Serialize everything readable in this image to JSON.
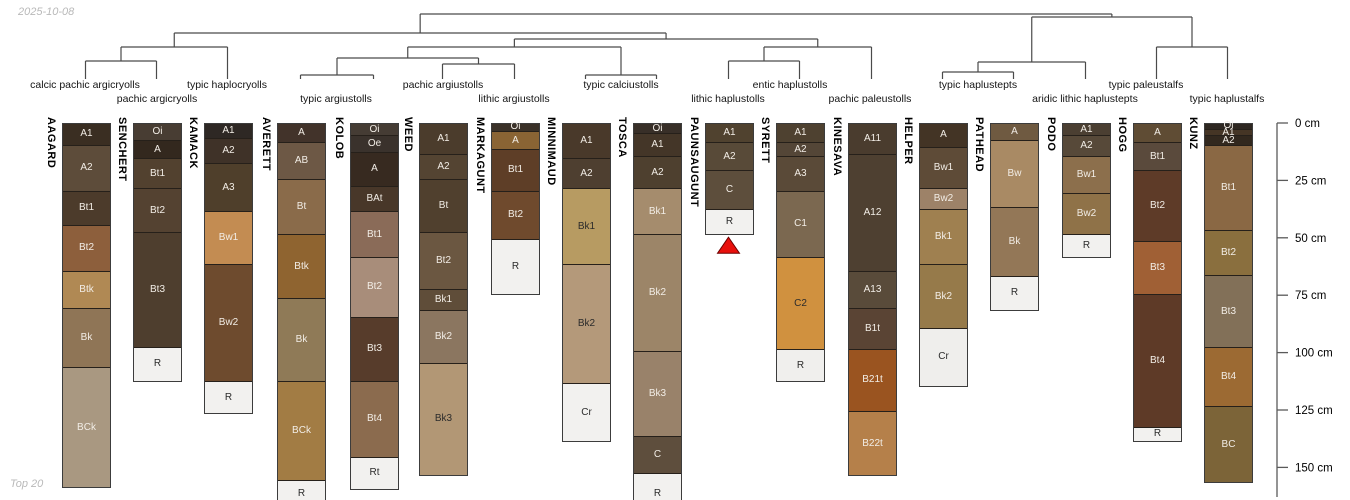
{
  "meta": {
    "date_label": "2025-10-08",
    "footer_label": "Top 20"
  },
  "colors": {
    "dendrogram_line": "#4a4a4a",
    "axis_line": "#5a5a5a",
    "column_border": "#3c3c3c",
    "horizon_divider": "#26201a",
    "label_light": "#f2ede6",
    "label_dark": "#2b2b2b",
    "marker_fill": "#e8100c",
    "marker_border": "#6d0000"
  },
  "chart_data": {
    "type": "soil-profile-dendrogram",
    "description": "Dendrogram of 17 soil series grouped by subgroup taxonomy above soil profile sketches with horizon designations and a depth axis in cm",
    "depth_axis": {
      "unit": "cm",
      "ticks": [
        0,
        25,
        50,
        75,
        100,
        125,
        150
      ],
      "tick_suffix": " cm"
    },
    "taxa_labels": [
      {
        "text": "calcic pachic argicryolls",
        "x": 85,
        "row": 1
      },
      {
        "text": "pachic argicryolls",
        "x": 157,
        "row": 2
      },
      {
        "text": "typic haplocryolls",
        "x": 227,
        "row": 1
      },
      {
        "text": "typic argiustolls",
        "x": 336,
        "row": 2
      },
      {
        "text": "pachic argiustolls",
        "x": 443,
        "row": 1
      },
      {
        "text": "lithic argiustolls",
        "x": 514,
        "row": 2
      },
      {
        "text": "typic calciustolls",
        "x": 621,
        "row": 1
      },
      {
        "text": "lithic haplustolls",
        "x": 728,
        "row": 2
      },
      {
        "text": "entic haplustolls",
        "x": 790,
        "row": 1
      },
      {
        "text": "pachic paleustolls",
        "x": 870,
        "row": 2
      },
      {
        "text": "typic haplustepts",
        "x": 978,
        "row": 1
      },
      {
        "text": "aridic lithic haplustepts",
        "x": 1085,
        "row": 2
      },
      {
        "text": "typic paleustalfs",
        "x": 1146,
        "row": 1
      },
      {
        "text": "typic haplustalfs",
        "x": 1227,
        "row": 2
      }
    ],
    "profiles": [
      {
        "id": "AAGARD",
        "x": 62,
        "horizons": [
          [
            "A1",
            0,
            9,
            "#3a2e22"
          ],
          [
            "A2",
            9,
            29,
            "#5d4c3a"
          ],
          [
            "Bt1",
            29,
            44,
            "#4c3b2b"
          ],
          [
            "Bt2",
            44,
            64,
            "#8d5f3c"
          ],
          [
            "Btk",
            64,
            80,
            "#b08954"
          ],
          [
            "Bk",
            80,
            106,
            "#8f7556"
          ],
          [
            "BCk",
            106,
            158,
            "#a99881"
          ]
        ]
      },
      {
        "id": "SENCHERT",
        "x": 133,
        "horizons": [
          [
            "Oi",
            0,
            7,
            "#483d33"
          ],
          [
            "A",
            7,
            15,
            "#33281e"
          ],
          [
            "Bt1",
            15,
            28,
            "#52412f"
          ],
          [
            "Bt2",
            28,
            47,
            "#544231"
          ],
          [
            "Bt3",
            47,
            97,
            "#4e3e2e"
          ],
          [
            "R",
            97,
            112,
            "#f2f1ef"
          ]
        ]
      },
      {
        "id": "KAMACK",
        "x": 204,
        "horizons": [
          [
            "A1",
            0,
            6,
            "#2e2824"
          ],
          [
            "A2",
            6,
            17,
            "#3f3228"
          ],
          [
            "A3",
            17,
            38,
            "#4f3f2b"
          ],
          [
            "Bw1",
            38,
            61,
            "#c38c52"
          ],
          [
            "Bw2",
            61,
            112,
            "#6e4b2e"
          ],
          [
            "R",
            112,
            126,
            "#f2f1ef"
          ]
        ]
      },
      {
        "id": "AVERETT",
        "x": 277,
        "horizons": [
          [
            "A",
            0,
            8,
            "#42332a"
          ],
          [
            "AB",
            8,
            24,
            "#6d5845"
          ],
          [
            "Bt",
            24,
            48,
            "#8a6b4a"
          ],
          [
            "Btk",
            48,
            76,
            "#8f6430"
          ],
          [
            "Bk",
            76,
            112,
            "#8f7a57"
          ],
          [
            "BCk",
            112,
            155,
            "#a27c44"
          ],
          [
            "R",
            155,
            167,
            "#f2f1ef"
          ]
        ]
      },
      {
        "id": "KOLOB",
        "x": 350,
        "horizons": [
          [
            "Oi",
            0,
            5,
            "#453c34"
          ],
          [
            "Oe",
            5,
            12,
            "#3a322c"
          ],
          [
            "A",
            12,
            27,
            "#372a20"
          ],
          [
            "BAt",
            27,
            38,
            "#483729"
          ],
          [
            "Bt1",
            38,
            58,
            "#8a6b58"
          ],
          [
            "Bt2",
            58,
            84,
            "#a88d7a"
          ],
          [
            "Bt3",
            84,
            112,
            "#573c2b"
          ],
          [
            "Bt4",
            112,
            145,
            "#8b6b4e"
          ],
          [
            "Rt",
            145,
            159,
            "#f2f1ef"
          ]
        ]
      },
      {
        "id": "WEED",
        "x": 419,
        "horizons": [
          [
            "A1",
            0,
            13,
            "#4b3c2c"
          ],
          [
            "A2",
            13,
            24,
            "#544432"
          ],
          [
            "Bt",
            24,
            47,
            "#50402e"
          ],
          [
            "Bt2",
            47,
            72,
            "#6b5741"
          ],
          [
            "Bk1",
            72,
            81,
            "#5f4d39"
          ],
          [
            "Bk2",
            81,
            104,
            "#8b7660"
          ],
          [
            "Bk3",
            104,
            153,
            "#b29775",
            "dark"
          ]
        ]
      },
      {
        "id": "MARKAGUNT",
        "x": 491,
        "horizons": [
          [
            "Oi",
            0,
            3,
            "#3a3128"
          ],
          [
            "A",
            3,
            11,
            "#8a6434"
          ],
          [
            "Bt1",
            11,
            29,
            "#5e3e27"
          ],
          [
            "Bt2",
            29,
            50,
            "#6f4a2d"
          ],
          [
            "R",
            50,
            74,
            "#f2f1ef"
          ]
        ]
      },
      {
        "id": "MINNIMAUD",
        "x": 562,
        "horizons": [
          [
            "A1",
            0,
            15,
            "#49392a"
          ],
          [
            "A2",
            15,
            28,
            "#4e3f30"
          ],
          [
            "Bk1",
            28,
            61,
            "#b79b62",
            "dark"
          ],
          [
            "Bk2",
            61,
            113,
            "#b4997a",
            "dark"
          ],
          [
            "Cr",
            113,
            138,
            "#f2f1ef"
          ]
        ]
      },
      {
        "id": "TOSCA",
        "x": 633,
        "horizons": [
          [
            "Oi",
            0,
            4,
            "#382f28"
          ],
          [
            "A1",
            4,
            14,
            "#443628"
          ],
          [
            "A2",
            14,
            28,
            "#4e402f"
          ],
          [
            "Bk1",
            28,
            48,
            "#a58c6d"
          ],
          [
            "Bk2",
            48,
            99,
            "#9c8568"
          ],
          [
            "Bk3",
            99,
            136,
            "#99826a"
          ],
          [
            "C",
            136,
            152,
            "#5e4e3d"
          ],
          [
            "R",
            152,
            170,
            "#f2f1ef"
          ]
        ]
      },
      {
        "id": "PAUNSAUGUNT",
        "x": 705,
        "horizons": [
          [
            "A1",
            0,
            8,
            "#50422f"
          ],
          [
            "A2",
            8,
            20,
            "#584a38"
          ],
          [
            "C",
            20,
            37,
            "#5d4e3c"
          ],
          [
            "R",
            37,
            48,
            "#f2f1ef"
          ]
        ]
      },
      {
        "id": "SYRETT",
        "x": 776,
        "horizons": [
          [
            "A1",
            0,
            8,
            "#4e4130"
          ],
          [
            "A2",
            8,
            14,
            "#544637"
          ],
          [
            "A3",
            14,
            29,
            "#5a4a38"
          ],
          [
            "C1",
            29,
            58,
            "#7b6850"
          ],
          [
            "C2",
            58,
            98,
            "#d0913f",
            "dark"
          ],
          [
            "R",
            98,
            112,
            "#f0efed"
          ]
        ]
      },
      {
        "id": "KINESAVA",
        "x": 848,
        "horizons": [
          [
            "A11",
            0,
            13,
            "#4a3c2e"
          ],
          [
            "A12",
            13,
            64,
            "#4e4031"
          ],
          [
            "A13",
            64,
            80,
            "#594b3a"
          ],
          [
            "B1t",
            80,
            98,
            "#5a4434"
          ],
          [
            "B21t",
            98,
            125,
            "#9a5420"
          ],
          [
            "B22t",
            125,
            153,
            "#b5804a"
          ]
        ]
      },
      {
        "id": "HELPER",
        "x": 919,
        "horizons": [
          [
            "A",
            0,
            10,
            "#433425"
          ],
          [
            "Bw1",
            10,
            28,
            "#5e4b37"
          ],
          [
            "Bw2",
            28,
            37,
            "#9d8268"
          ],
          [
            "Bk1",
            37,
            61,
            "#9f8050"
          ],
          [
            "Bk2",
            61,
            89,
            "#967a4a"
          ],
          [
            "Cr",
            89,
            114,
            "#efeeec"
          ]
        ]
      },
      {
        "id": "PATHEAD",
        "x": 990,
        "horizons": [
          [
            "A",
            0,
            7,
            "#6f5a41"
          ],
          [
            "Bw",
            7,
            36,
            "#a98a64"
          ],
          [
            "Bk",
            36,
            66,
            "#937757"
          ],
          [
            "R",
            66,
            81,
            "#f2f1ef"
          ]
        ]
      },
      {
        "id": "PODO",
        "x": 1062,
        "horizons": [
          [
            "A1",
            0,
            5,
            "#4b3f32"
          ],
          [
            "A2",
            5,
            14,
            "#574939"
          ],
          [
            "Bw1",
            14,
            30,
            "#8c6f4c"
          ],
          [
            "Bw2",
            30,
            48,
            "#8f7248"
          ],
          [
            "R",
            48,
            58,
            "#f2f1ef"
          ]
        ]
      },
      {
        "id": "HOGG",
        "x": 1133,
        "horizons": [
          [
            "A",
            0,
            8,
            "#5f4c34"
          ],
          [
            "Bt1",
            8,
            20,
            "#5a4a3c"
          ],
          [
            "Bt2",
            20,
            51,
            "#5e3b28"
          ],
          [
            "Bt3",
            51,
            74,
            "#a06035"
          ],
          [
            "Bt4",
            74,
            132,
            "#5e3a27"
          ],
          [
            "R",
            132,
            138,
            "#f2f1ef"
          ]
        ]
      },
      {
        "id": "KUNZ",
        "x": 1204,
        "horizons": [
          [
            "Oi",
            0,
            2,
            "#2e2721"
          ],
          [
            "A1",
            2,
            5,
            "#453525"
          ],
          [
            "A2",
            5,
            9,
            "#32281e"
          ],
          [
            "Bt1",
            9,
            46,
            "#8a6844"
          ],
          [
            "Bt2",
            46,
            66,
            "#8a6f3e"
          ],
          [
            "Bt3",
            66,
            97,
            "#827058"
          ],
          [
            "Bt4",
            97,
            123,
            "#9c6a33"
          ],
          [
            "BC",
            123,
            156,
            "#7c6438"
          ]
        ]
      }
    ],
    "dendrogram": {
      "leaf_tick_bottom_y": 79,
      "merges": [
        [
          "m1",
          "AAGARD",
          "SENCHERT",
          61
        ],
        [
          "m2",
          "m1",
          "KAMACK",
          47
        ],
        [
          "m3",
          "AVERETT",
          "KOLOB",
          75
        ],
        [
          "m4",
          "WEED",
          "MARKAGUNT",
          64
        ],
        [
          "m5",
          "m3",
          "m4",
          58
        ],
        [
          "m6",
          "MINNIMAUD",
          "TOSCA",
          75
        ],
        [
          "m7",
          "m5",
          "m6",
          47
        ],
        [
          "m8",
          "PAUNSAUGUNT",
          "SYRETT",
          61
        ],
        [
          "m9",
          "m8",
          "KINESAVA",
          47
        ],
        [
          "m10",
          "m7",
          "m9",
          39
        ],
        [
          "m11",
          "m2",
          "m10",
          33
        ],
        [
          "m12",
          "HELPER",
          "PATHEAD",
          72
        ],
        [
          "m13",
          "m12",
          "PODO",
          62
        ],
        [
          "m14",
          "HOGG",
          "KUNZ",
          47
        ],
        [
          "m15",
          "m13",
          "m14",
          17
        ],
        [
          "m16",
          "m11",
          "m15",
          14
        ]
      ]
    },
    "marker": {
      "profile_id": "PAUNSAUGUNT",
      "shape": "triangle-up",
      "depth": 48
    }
  }
}
